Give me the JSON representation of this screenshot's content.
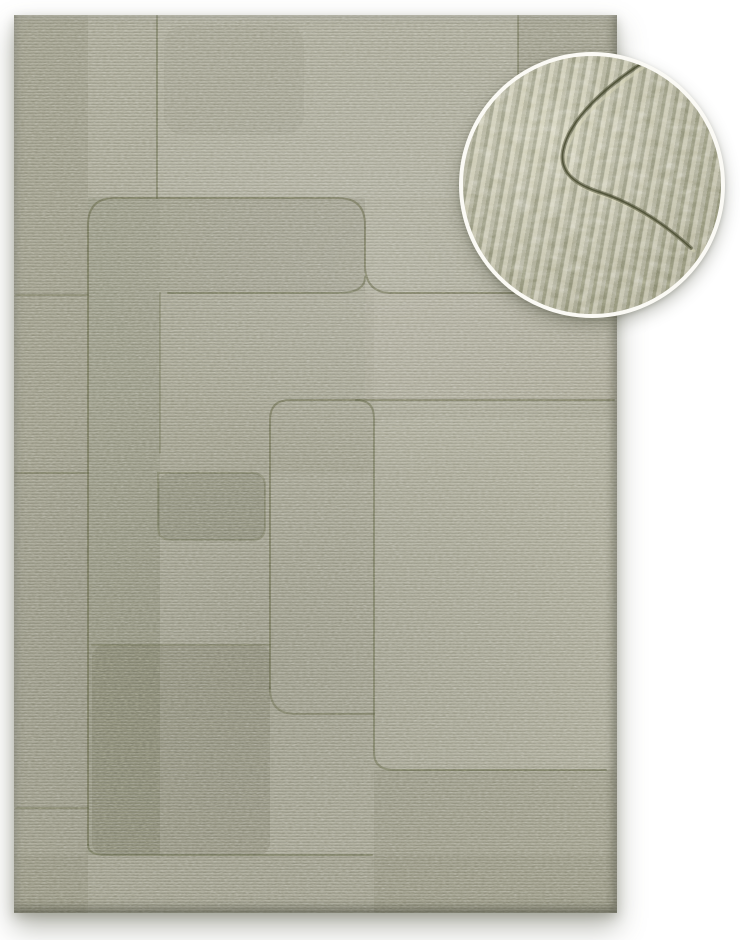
{
  "scene": {
    "type": "product-photo",
    "subject": "Sage green hand-carved wool rug with geometric rounded-rectangle relief pattern and circular fabric texture close-up inset",
    "background_color": "#ffffff"
  },
  "rug": {
    "left": 14,
    "top": 15,
    "width": 603,
    "height": 898,
    "base_color": "#a5a492",
    "groove_color": "#53563c",
    "patch_dark_color": "#32341f",
    "patch_light_color": "#f4f2e2",
    "grooves": [
      {
        "d": "M 143,0 L 143,183",
        "opacity": 0.45
      },
      {
        "d": "M 504,0 L 504,278",
        "opacity": 0.4
      },
      {
        "d": "M 74,830 L 74,210 Q 74,183 101,183 L 324,183 Q 351,183 351,210 L 351,250 Q 351,278 378,278 L 600,278",
        "opacity": 0.5
      },
      {
        "d": "M 351,262 Q 351,278 324,278 L 154,278",
        "opacity": 0.45
      },
      {
        "d": "M 74,830 Q 74,840 92,840 L 358,840",
        "opacity": 0.45
      },
      {
        "d": "M 2,280 L 74,280",
        "opacity": 0.35
      },
      {
        "d": "M 2,458 L 74,458",
        "opacity": 0.35
      },
      {
        "d": "M 2,793 L 74,793",
        "opacity": 0.35
      },
      {
        "d": "M 146,278 L 146,438",
        "opacity": 0.3
      },
      {
        "d": "M 256,673 L 256,405 Q 256,385 276,385 L 600,385",
        "opacity": 0.5
      },
      {
        "d": "M 342,385 Q 360,385 360,403 L 360,737 Q 360,755 380,755 L 592,755",
        "opacity": 0.45
      },
      {
        "d": "M 256,673 Q 256,699 282,699 L 360,699",
        "opacity": 0.4
      },
      {
        "d": "M 78,630 L 256,630",
        "opacity": 0.3
      },
      {
        "d": "M 144,458 L 144,512 Q 144,525 157,525 L 238,525 Q 251,525 251,512 L 251,471 Q 251,458 238,458 L 157,458 Q 144,458 144,458 Z",
        "opacity": 0.3
      }
    ],
    "patches": [
      {
        "x": 0,
        "y": 0,
        "w": 74,
        "h": 898,
        "rx": 0,
        "tone": "dark",
        "opacity": 0.09
      },
      {
        "x": 74,
        "y": 183,
        "w": 72,
        "h": 657,
        "rx": 0,
        "tone": "dark",
        "opacity": 0.11
      },
      {
        "x": 146,
        "y": 183,
        "w": 205,
        "h": 95,
        "rx": 0,
        "tone": "dark",
        "opacity": 0.09
      },
      {
        "x": 146,
        "y": 278,
        "w": 214,
        "h": 180,
        "rx": 0,
        "tone": "dark",
        "opacity": 0.04
      },
      {
        "x": 144,
        "y": 458,
        "w": 107,
        "h": 67,
        "rx": 13,
        "tone": "dark",
        "opacity": 0.15
      },
      {
        "x": 78,
        "y": 630,
        "w": 178,
        "h": 210,
        "rx": 12,
        "tone": "dark",
        "opacity": 0.12
      },
      {
        "x": 360,
        "y": 403,
        "w": 243,
        "h": 352,
        "rx": 14,
        "tone": "light",
        "opacity": 0.06
      },
      {
        "x": 360,
        "y": 755,
        "w": 243,
        "h": 143,
        "rx": 0,
        "tone": "dark",
        "opacity": 0.07
      },
      {
        "x": 504,
        "y": 0,
        "w": 99,
        "h": 278,
        "rx": 0,
        "tone": "dark",
        "opacity": 0.06
      },
      {
        "x": 143,
        "y": 0,
        "w": 361,
        "h": 183,
        "rx": 0,
        "tone": "light",
        "opacity": 0.05
      },
      {
        "x": 351,
        "y": 278,
        "w": 252,
        "h": 107,
        "rx": 0,
        "tone": "light",
        "opacity": 0.04
      },
      {
        "x": 0,
        "y": 840,
        "w": 603,
        "h": 58,
        "rx": 0,
        "tone": "dark",
        "opacity": 0.05
      },
      {
        "x": 150,
        "y": 10,
        "w": 140,
        "h": 110,
        "rx": 20,
        "tone": "dark",
        "opacity": 0.05
      }
    ]
  },
  "inset": {
    "center_x": 592,
    "center_y": 185,
    "radius": 129,
    "ring_color": "#fbfaf5",
    "ring_width": 4,
    "base_color": "#b4b39a",
    "yarn_light": "#d9d6b8",
    "yarn_dark": "#7f815f",
    "crease_color": "#4a4d33",
    "crease_d": "M 184,4 C 146,28 106,62 100,95 C 96,117 113,129 139,137 C 172,148 204,170 228,192"
  }
}
